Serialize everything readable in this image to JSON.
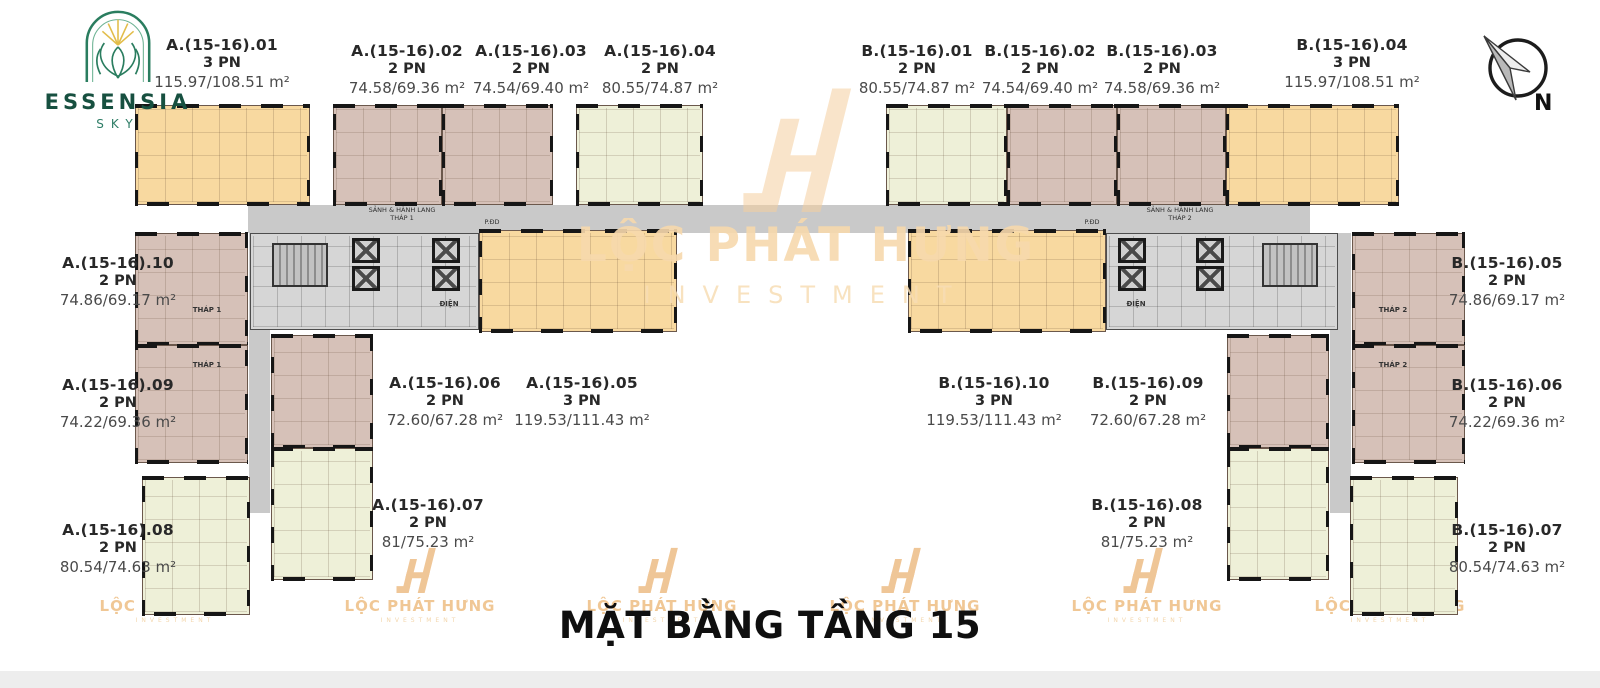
{
  "brand": {
    "name": "ESSENSIA",
    "sub": "SKY"
  },
  "compass": {
    "label": "N"
  },
  "title": "MẶT BẰNG TẦNG 15",
  "watermark": {
    "line1": "LỘC PHÁT HƯNG",
    "line2": "INVESTMENT"
  },
  "corridor": {
    "hall_label": "SẢNH & HÀNH LANG",
    "tower1": "THÁP 1",
    "tower2": "THÁP 2",
    "room": "P.ĐD"
  },
  "core": {
    "electrical": "ĐIỆN"
  },
  "wing_labels": {
    "tower1": "THÁP 1",
    "tower2": "THÁP 2"
  },
  "colors": {
    "unit_3pn_orange": "#f8d9a0",
    "unit_2pn_tan": "#d6c1b8",
    "unit_2pn_green": "#eef0d8",
    "corridor_gray": "#c9c9c9",
    "core_gray": "#d6d6d6",
    "watermark_orange": "#f0c795",
    "brand_green": "#175040",
    "title_black": "#0f0f0f"
  },
  "units": [
    {
      "id": "A.01",
      "code": "A.(15-16).01",
      "bedrooms": "3 PN",
      "area": "115.97/108.51 m²"
    },
    {
      "id": "A.02",
      "code": "A.(15-16).02",
      "bedrooms": "2 PN",
      "area": "74.58/69.36 m²"
    },
    {
      "id": "A.03",
      "code": "A.(15-16).03",
      "bedrooms": "2 PN",
      "area": "74.54/69.40 m²"
    },
    {
      "id": "A.04",
      "code": "A.(15-16).04",
      "bedrooms": "2 PN",
      "area": "80.55/74.87 m²"
    },
    {
      "id": "A.05",
      "code": "A.(15-16).05",
      "bedrooms": "3 PN",
      "area": "119.53/111.43 m²"
    },
    {
      "id": "A.06",
      "code": "A.(15-16).06",
      "bedrooms": "2 PN",
      "area": "72.60/67.28 m²"
    },
    {
      "id": "A.07",
      "code": "A.(15-16).07",
      "bedrooms": "2 PN",
      "area": "81/75.23 m²"
    },
    {
      "id": "A.08",
      "code": "A.(15-16).08",
      "bedrooms": "2 PN",
      "area": "80.54/74.63 m²"
    },
    {
      "id": "A.09",
      "code": "A.(15-16).09",
      "bedrooms": "2 PN",
      "area": "74.22/69.36 m²"
    },
    {
      "id": "A.10",
      "code": "A.(15-16).10",
      "bedrooms": "2 PN",
      "area": "74.86/69.17 m²"
    },
    {
      "id": "B.01",
      "code": "B.(15-16).01",
      "bedrooms": "2 PN",
      "area": "80.55/74.87 m²"
    },
    {
      "id": "B.02",
      "code": "B.(15-16).02",
      "bedrooms": "2 PN",
      "area": "74.54/69.40 m²"
    },
    {
      "id": "B.03",
      "code": "B.(15-16).03",
      "bedrooms": "2 PN",
      "area": "74.58/69.36 m²"
    },
    {
      "id": "B.04",
      "code": "B.(15-16).04",
      "bedrooms": "3 PN",
      "area": "115.97/108.51 m²"
    },
    {
      "id": "B.05",
      "code": "B.(15-16).05",
      "bedrooms": "2 PN",
      "area": "74.86/69.17 m²"
    },
    {
      "id": "B.06",
      "code": "B.(15-16).06",
      "bedrooms": "2 PN",
      "area": "74.22/69.36 m²"
    },
    {
      "id": "B.07",
      "code": "B.(15-16).07",
      "bedrooms": "2 PN",
      "area": "80.54/74.63 m²"
    },
    {
      "id": "B.08",
      "code": "B.(15-16).08",
      "bedrooms": "2 PN",
      "area": "81/75.23 m²"
    },
    {
      "id": "B.09",
      "code": "B.(15-16).09",
      "bedrooms": "2 PN",
      "area": "72.60/67.28 m²"
    },
    {
      "id": "B.10",
      "code": "B.(15-16).10",
      "bedrooms": "3 PN",
      "area": "119.53/111.43 m²"
    }
  ]
}
